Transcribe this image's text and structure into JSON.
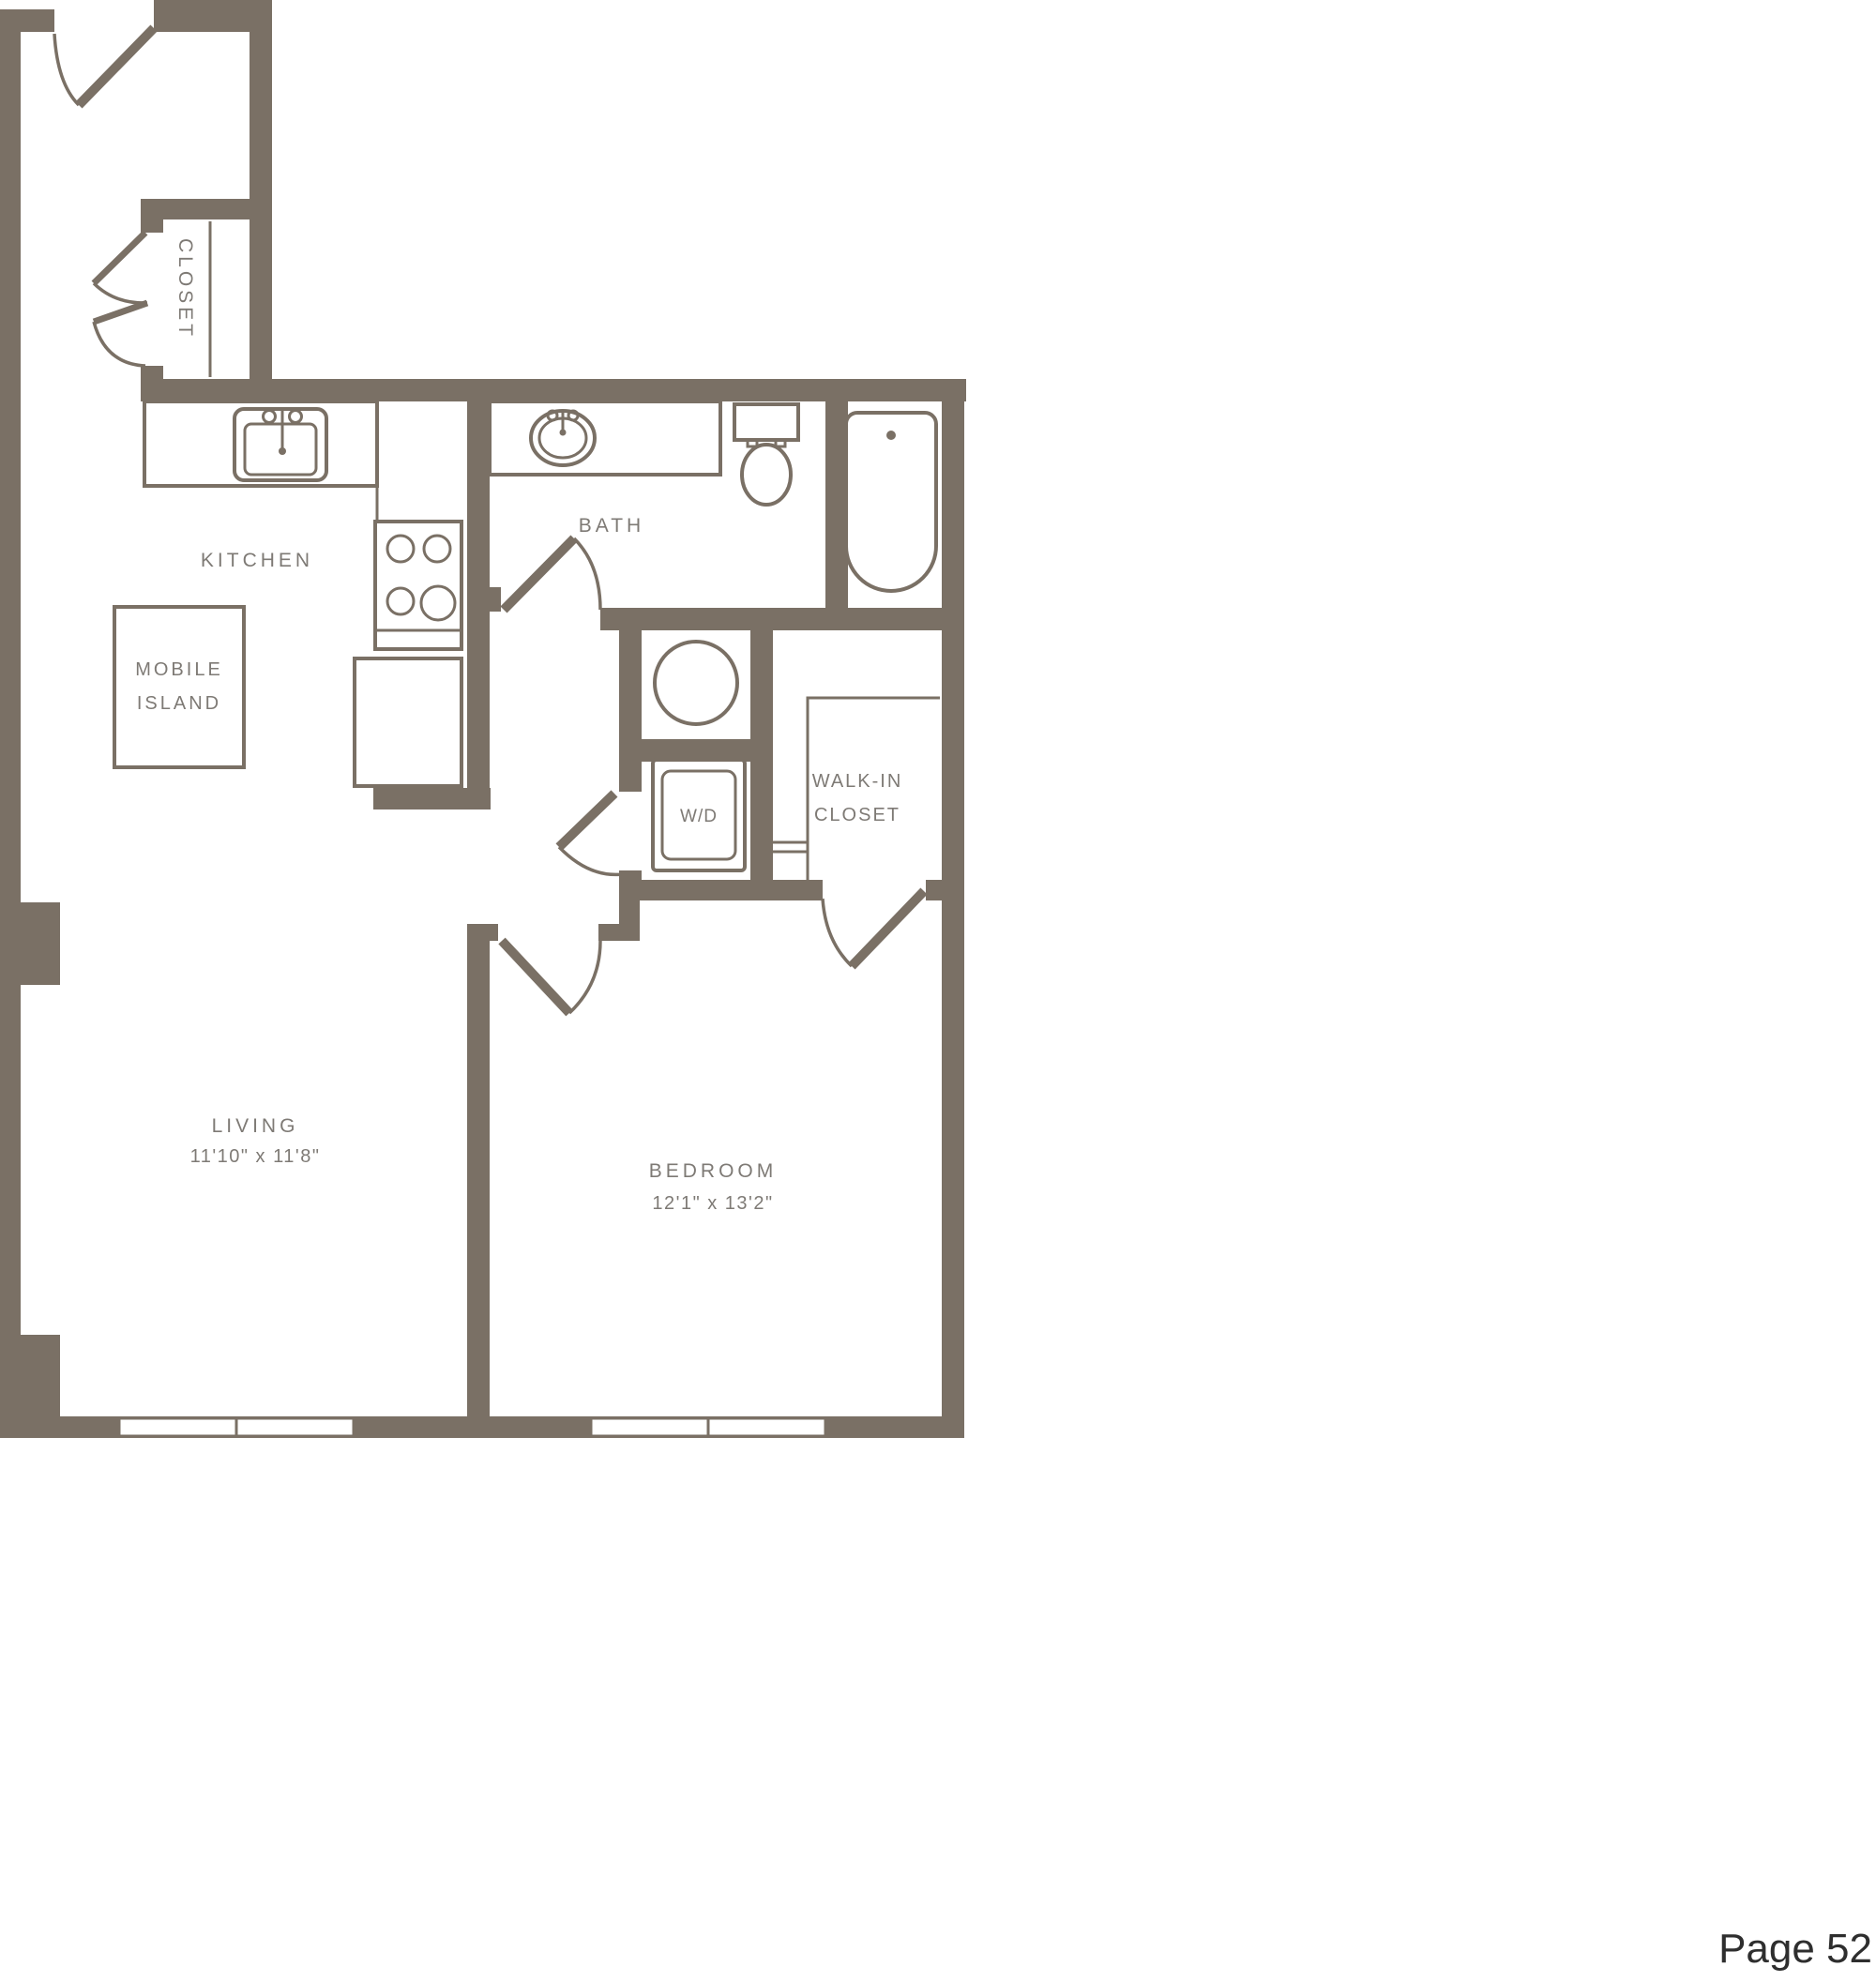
{
  "page": {
    "label": "Page 52"
  },
  "colors": {
    "wall": "#7a7065",
    "label": "#7e7a75",
    "page_text": "#2e2e2e",
    "background": "#ffffff"
  },
  "rooms": {
    "closet": {
      "label": "CLOSET"
    },
    "kitchen": {
      "label": "KITCHEN"
    },
    "mobile_island": {
      "line1": "MOBILE",
      "line2": "ISLAND"
    },
    "bath": {
      "label": "BATH"
    },
    "laundry": {
      "label": "W/D"
    },
    "walk_in_closet": {
      "line1": "WALK-IN",
      "line2": "CLOSET"
    },
    "living": {
      "label": "LIVING",
      "dimensions": "11'10\" x 11'8\""
    },
    "bedroom": {
      "label": "BEDROOM",
      "dimensions": "12'1\" x 13'2\""
    }
  },
  "fixtures": [
    "entry-door",
    "closet-bifold-door",
    "closet-rod",
    "kitchen-sink",
    "stove",
    "refrigerator",
    "mobile-island",
    "bath-vanity",
    "bath-sink",
    "toilet",
    "bathtub",
    "bath-door",
    "hall-door",
    "water-heater",
    "washer-dryer",
    "bedroom-door",
    "walk-in-closet-door",
    "walk-in-closet-shelving",
    "living-windows",
    "bedroom-windows"
  ]
}
